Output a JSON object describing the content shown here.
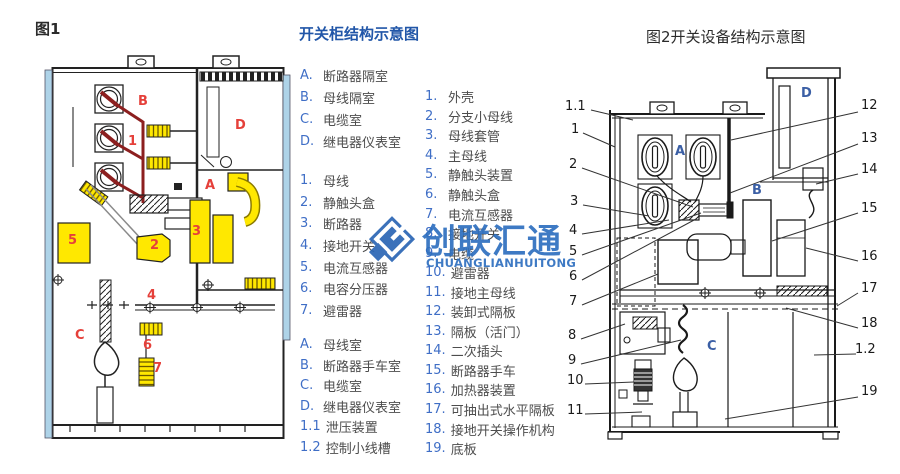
{
  "fig1": {
    "caption": "图1",
    "part_labels": [
      "B",
      "D",
      "1",
      "A",
      "5",
      "3",
      "2",
      "4",
      "C",
      "6",
      "7"
    ]
  },
  "legend": {
    "title": "开关柜结构示意图",
    "rooms1": [
      {
        "k": "A.",
        "t": "断路器隔室"
      },
      {
        "k": "B.",
        "t": "母线隔室"
      },
      {
        "k": "C.",
        "t": "电缆室"
      },
      {
        "k": "D.",
        "t": "继电器仪表室"
      }
    ],
    "parts1": [
      {
        "k": "1.",
        "t": "母线"
      },
      {
        "k": "2.",
        "t": "静触头盒"
      },
      {
        "k": "3.",
        "t": "断路器"
      },
      {
        "k": "4.",
        "t": "接地开关"
      },
      {
        "k": "5.",
        "t": "电流互感器"
      },
      {
        "k": "6.",
        "t": "电容分压器"
      },
      {
        "k": "7.",
        "t": "避雷器"
      }
    ],
    "rooms2": [
      {
        "k": "A.",
        "t": "母线室"
      },
      {
        "k": "B.",
        "t": "断路器手车室"
      },
      {
        "k": "C.",
        "t": "电缆室"
      },
      {
        "k": "D.",
        "t": "继电器仪表室"
      },
      {
        "k": "1.1",
        "t": "泄压装置"
      },
      {
        "k": "1.2",
        "t": "控制小线槽"
      }
    ],
    "parts2": [
      {
        "k": "1.",
        "t": "外壳"
      },
      {
        "k": "2.",
        "t": "分支小母线"
      },
      {
        "k": "3.",
        "t": "母线套管"
      },
      {
        "k": "4.",
        "t": "主母线"
      },
      {
        "k": "5.",
        "t": "静触头装置"
      },
      {
        "k": "6.",
        "t": "静触头盒"
      },
      {
        "k": "7.",
        "t": "电流互感器"
      },
      {
        "k": "8.",
        "t": "接地开关"
      },
      {
        "k": "9.",
        "t": "电缆"
      },
      {
        "k": "10.",
        "t": "避雷器"
      },
      {
        "k": "11.",
        "t": "接地主母线"
      },
      {
        "k": "12.",
        "t": "装卸式隔板"
      },
      {
        "k": "13.",
        "t": "隔板（活门）"
      },
      {
        "k": "14.",
        "t": "二次插头"
      },
      {
        "k": "15.",
        "t": "断路器手车"
      },
      {
        "k": "16.",
        "t": "加热器装置"
      },
      {
        "k": "17.",
        "t": "可抽出式水平隔板"
      },
      {
        "k": "18.",
        "t": "接地开关操作机构"
      },
      {
        "k": "19.",
        "t": "底板"
      }
    ]
  },
  "fig2": {
    "caption": "图2开关设备结构示意图",
    "left_labels": [
      "1.1",
      "1",
      "2",
      "3",
      "4",
      "5",
      "6",
      "7",
      "8",
      "9",
      "10",
      "11"
    ],
    "right_labels": [
      "12",
      "13",
      "14",
      "15",
      "16",
      "17",
      "18",
      "1.2",
      "19"
    ],
    "compartments": [
      "A",
      "B",
      "C",
      "D"
    ]
  },
  "watermark": {
    "text": "创联汇通",
    "subtext": "CHUANGLIANHUITONG"
  },
  "colors": {
    "title_blue": "#2156a8",
    "list_key_blue": "#3f6ec6",
    "fig1_label_red": "#e5403a",
    "fig1_busbar_dark_red": "#8c1f1f",
    "fig1_component_yellow": "#ffe800",
    "fig1_side_strip_blue": "#aed3e8",
    "fig2_letter_blue": "#3b5fa5",
    "watermark_blue": "#2e6fbf"
  }
}
